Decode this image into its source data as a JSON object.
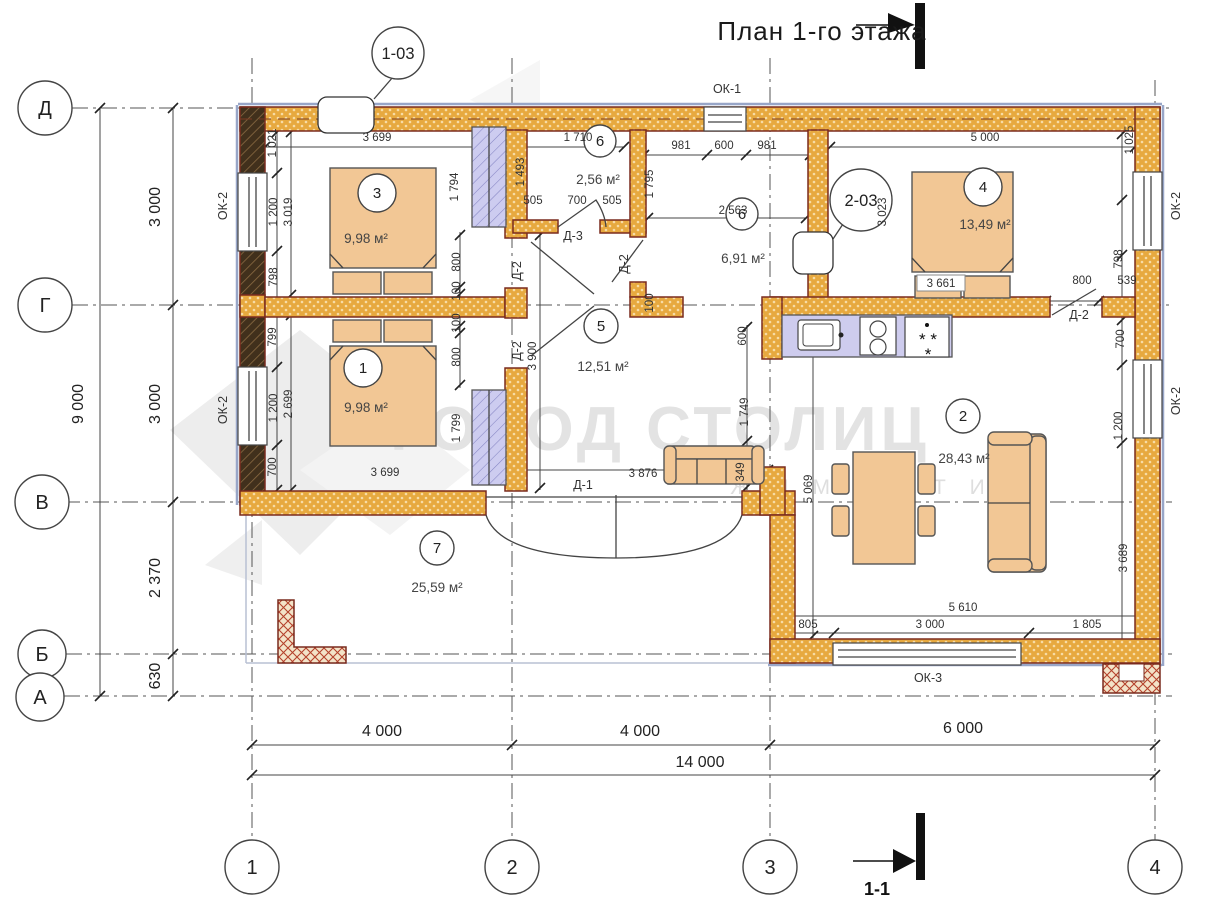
{
  "title": "План 1-го этажа",
  "watermark": {
    "main": "ГОРОД СТОЛИЦ",
    "sub": "Ж И М О С Т И"
  },
  "section": {
    "label": "1-1"
  },
  "axes": {
    "horizontal": [
      "Д",
      "Г",
      "В",
      "Б",
      "А"
    ],
    "vertical": [
      "1",
      "2",
      "3",
      "4"
    ]
  },
  "overall_dimensions": {
    "width": "14 000",
    "height": "9 000"
  },
  "rooms": [
    {
      "number": "3",
      "area": "9,98 м²"
    },
    {
      "number": "1",
      "area": "9,98 м²"
    },
    {
      "number": "4",
      "area": "13,49 м²"
    },
    {
      "number": "5",
      "area": "12,51 м²"
    },
    {
      "number": "6",
      "area": "2,56 м²"
    },
    {
      "number": "6",
      "area": "6,91 м²"
    },
    {
      "number": "2",
      "area": "28,43 м²"
    },
    {
      "number": "7",
      "area": "25,59 м²"
    }
  ],
  "windows": [
    "ОК-1",
    "ОК-2",
    "ОК-3"
  ],
  "doors": [
    "Д-1",
    "Д-2",
    "Д-3"
  ],
  "callouts": [
    "1-03",
    "2-03"
  ],
  "labels": [
    {
      "n": "dim-3699-top",
      "t": "3 699",
      "x": 377,
      "y": 141
    },
    {
      "n": "dim-1710",
      "t": "1 710",
      "x": 578,
      "y": 141
    },
    {
      "n": "dim-981-l",
      "t": "981",
      "x": 681,
      "y": 149
    },
    {
      "n": "dim-600",
      "t": "600",
      "x": 724,
      "y": 149
    },
    {
      "n": "dim-981-r",
      "t": "981",
      "x": 767,
      "y": 149
    },
    {
      "n": "dim-5000",
      "t": "5 000",
      "x": 985,
      "y": 141
    },
    {
      "n": "dim-505-l",
      "t": "505",
      "x": 533,
      "y": 204
    },
    {
      "n": "dim-700-wc",
      "t": "700",
      "x": 577,
      "y": 204
    },
    {
      "n": "dim-505-r",
      "t": "505",
      "x": 612,
      "y": 204
    },
    {
      "n": "dim-2563",
      "t": "2 563",
      "x": 733,
      "y": 214
    },
    {
      "n": "dim-3661",
      "t": "3 661",
      "x": 941,
      "y": 287,
      "c": "dimbox"
    },
    {
      "n": "dim-800-door4",
      "t": "800",
      "x": 1082,
      "y": 284
    },
    {
      "n": "dim-539",
      "t": "539",
      "x": 1127,
      "y": 284
    },
    {
      "n": "dim-3876",
      "t": "3 876",
      "x": 643,
      "y": 477
    },
    {
      "n": "dim-3699-bot",
      "t": "3 699",
      "x": 385,
      "y": 476
    },
    {
      "n": "dim-5610",
      "t": "5 610",
      "x": 963,
      "y": 611
    },
    {
      "n": "dim-805",
      "t": "805",
      "x": 808,
      "y": 628
    },
    {
      "n": "dim-3000-okno",
      "t": "3 000",
      "x": 930,
      "y": 628
    },
    {
      "n": "dim-1805",
      "t": "1 805",
      "x": 1087,
      "y": 628
    },
    {
      "n": "dim-4000-a",
      "t": "4 000",
      "x": 382,
      "y": 736,
      "c": "dimL"
    },
    {
      "n": "dim-4000-b",
      "t": "4 000",
      "x": 640,
      "y": 736,
      "c": "dimL"
    },
    {
      "n": "dim-6000",
      "t": "6 000",
      "x": 963,
      "y": 733,
      "c": "dimL"
    },
    {
      "n": "dim-14000",
      "t": "14 000",
      "x": 700,
      "y": 767,
      "c": "dimL"
    },
    {
      "n": "dim-1021",
      "t": "1 021",
      "x": 276,
      "y": 143,
      "r": -90
    },
    {
      "n": "dim-1025",
      "t": "1 025",
      "x": 1133,
      "y": 140,
      "r": -90
    },
    {
      "n": "dim-1794",
      "t": "1 794",
      "x": 458,
      "y": 187,
      "r": -90
    },
    {
      "n": "dim-1493",
      "t": "1 493",
      "x": 524,
      "y": 172,
      "r": -90
    },
    {
      "n": "dim-1795",
      "t": "1 795",
      "x": 653,
      "y": 184,
      "r": -90
    },
    {
      "n": "dim-3019",
      "t": "3 019",
      "x": 292,
      "y": 212,
      "r": -90
    },
    {
      "n": "dim-1200-l1",
      "t": "1 200",
      "x": 277,
      "y": 212,
      "r": -90
    },
    {
      "n": "dim-798-l",
      "t": "798",
      "x": 277,
      "y": 277,
      "r": -90
    },
    {
      "n": "dim-799",
      "t": "799",
      "x": 276,
      "y": 337,
      "r": -90
    },
    {
      "n": "dim-2699",
      "t": "2 699",
      "x": 292,
      "y": 404,
      "r": -90
    },
    {
      "n": "dim-1200-l2",
      "t": "1 200",
      "x": 277,
      "y": 408,
      "r": -90
    },
    {
      "n": "dim-700-l",
      "t": "700",
      "x": 276,
      "y": 467,
      "r": -90
    },
    {
      "n": "dim-3023",
      "t": "3 023",
      "x": 886,
      "y": 212,
      "r": -90
    },
    {
      "n": "dim-800-c1",
      "t": "800",
      "x": 460,
      "y": 262,
      "r": -90
    },
    {
      "n": "dim-100-c1",
      "t": "100",
      "x": 460,
      "y": 291,
      "r": -90
    },
    {
      "n": "dim-100-c2",
      "t": "100",
      "x": 460,
      "y": 323,
      "r": -90
    },
    {
      "n": "dim-800-c2",
      "t": "800",
      "x": 460,
      "y": 357,
      "r": -90
    },
    {
      "n": "dim-1799",
      "t": "1 799",
      "x": 460,
      "y": 428,
      "r": -90
    },
    {
      "n": "dim-3900",
      "t": "3 900",
      "x": 536,
      "y": 356,
      "r": -90
    },
    {
      "n": "dim-100-k",
      "t": "100",
      "x": 653,
      "y": 303,
      "r": -90
    },
    {
      "n": "dim-600-k",
      "t": "600",
      "x": 746,
      "y": 336,
      "r": -90
    },
    {
      "n": "dim-1749",
      "t": "1 749",
      "x": 748,
      "y": 412,
      "r": -90
    },
    {
      "n": "dim-349",
      "t": "349",
      "x": 744,
      "y": 472,
      "r": -90
    },
    {
      "n": "dim-5069",
      "t": "5 069",
      "x": 812,
      "y": 489,
      "r": -90
    },
    {
      "n": "dim-798-r",
      "t": "798",
      "x": 1122,
      "y": 259,
      "r": -90
    },
    {
      "n": "dim-700-r",
      "t": "700",
      "x": 1124,
      "y": 339,
      "r": -90
    },
    {
      "n": "dim-1200-r",
      "t": "1 200",
      "x": 1122,
      "y": 426,
      "r": -90
    },
    {
      "n": "dim-3689",
      "t": "3 689",
      "x": 1127,
      "y": 558,
      "r": -90
    },
    {
      "n": "dim-3000-dg",
      "t": "3 000",
      "x": 160,
      "y": 207,
      "r": -90,
      "c": "dimL"
    },
    {
      "n": "dim-3000-gv",
      "t": "3 000",
      "x": 160,
      "y": 404,
      "r": -90,
      "c": "dimL"
    },
    {
      "n": "dim-2370",
      "t": "2 370",
      "x": 160,
      "y": 578,
      "r": -90,
      "c": "dimL"
    },
    {
      "n": "dim-630",
      "t": "630",
      "x": 160,
      "y": 676,
      "r": -90,
      "c": "dimL"
    },
    {
      "n": "dim-9000",
      "t": "9 000",
      "x": 83,
      "y": 404,
      "r": -90,
      "c": "dimL"
    },
    {
      "n": "room3-area",
      "t": "9,98 м²",
      "x": 366,
      "y": 243,
      "c": "a"
    },
    {
      "n": "room1-area",
      "t": "9,98 м²",
      "x": 366,
      "y": 412,
      "c": "a"
    },
    {
      "n": "room4-area",
      "t": "13,49 м²",
      "x": 985,
      "y": 229,
      "c": "a"
    },
    {
      "n": "room5-area",
      "t": "12,51 м²",
      "x": 603,
      "y": 371,
      "c": "a"
    },
    {
      "n": "room6-area",
      "t": "2,56 м²",
      "x": 598,
      "y": 184,
      "c": "a"
    },
    {
      "n": "kitchen-area",
      "t": "6,91 м²",
      "x": 743,
      "y": 263,
      "c": "a"
    },
    {
      "n": "room2-area",
      "t": "28,43 м²",
      "x": 964,
      "y": 463,
      "c": "a"
    },
    {
      "n": "room7-area",
      "t": "25,59 м²",
      "x": 437,
      "y": 592,
      "c": "a"
    },
    {
      "n": "window-label-ok1",
      "t": "ОК-1",
      "x": 727,
      "y": 93,
      "c": "w"
    },
    {
      "n": "window-label-ok2-l1",
      "t": "ОК-2",
      "x": 227,
      "y": 206,
      "r": -90,
      "c": "w"
    },
    {
      "n": "window-label-ok2-l2",
      "t": "ОК-2",
      "x": 227,
      "y": 410,
      "r": -90,
      "c": "w"
    },
    {
      "n": "window-label-ok2-r1",
      "t": "ОК-2",
      "x": 1180,
      "y": 206,
      "r": -90,
      "c": "w"
    },
    {
      "n": "window-label-ok2-r2",
      "t": "ОК-2",
      "x": 1180,
      "y": 401,
      "r": -90,
      "c": "w"
    },
    {
      "n": "window-label-ok3",
      "t": "ОК-3",
      "x": 928,
      "y": 682,
      "c": "w"
    },
    {
      "n": "door-label-d1",
      "t": "Д-1",
      "x": 583,
      "y": 489,
      "c": "w"
    },
    {
      "n": "door-label-d3",
      "t": "Д-3",
      "x": 573,
      "y": 240,
      "c": "w"
    },
    {
      "n": "door-label-d2-a",
      "t": "Д-2",
      "x": 521,
      "y": 271,
      "r": -90,
      "c": "w"
    },
    {
      "n": "door-label-d2-b",
      "t": "Д-2",
      "x": 521,
      "y": 351,
      "r": -90,
      "c": "w"
    },
    {
      "n": "door-label-d2-c",
      "t": "Д-2",
      "x": 628,
      "y": 264,
      "r": -90,
      "c": "w"
    },
    {
      "n": "door-label-d2-d",
      "t": "Д-2",
      "x": 1079,
      "y": 319,
      "c": "w"
    },
    {
      "n": "section-label",
      "t": "1-1",
      "x": 877,
      "y": 895,
      "c": "sec"
    },
    {
      "n": "fridge-stars",
      "t": "*  *",
      "x": 928,
      "y": 345,
      "c": "star"
    },
    {
      "n": "fridge-star",
      "t": "*",
      "x": 928,
      "y": 360,
      "c": "star"
    }
  ],
  "circles": [
    {
      "n": "axis-D",
      "t": "Д",
      "x": 45,
      "y": 108,
      "rad": 27,
      "c": "ax"
    },
    {
      "n": "axis-G",
      "t": "Г",
      "x": 45,
      "y": 305,
      "rad": 27,
      "c": "ax"
    },
    {
      "n": "axis-V",
      "t": "В",
      "x": 42,
      "y": 502,
      "rad": 27,
      "c": "ax"
    },
    {
      "n": "axis-B",
      "t": "Б",
      "x": 42,
      "y": 654,
      "rad": 24,
      "c": "ax"
    },
    {
      "n": "axis-A",
      "t": "А",
      "x": 40,
      "y": 697,
      "rad": 24,
      "c": "ax"
    },
    {
      "n": "axis-1",
      "t": "1",
      "x": 252,
      "y": 867,
      "rad": 27,
      "c": "ax"
    },
    {
      "n": "axis-2",
      "t": "2",
      "x": 512,
      "y": 867,
      "rad": 27,
      "c": "ax"
    },
    {
      "n": "axis-3",
      "t": "3",
      "x": 770,
      "y": 867,
      "rad": 27,
      "c": "ax"
    },
    {
      "n": "axis-4",
      "t": "4",
      "x": 1155,
      "y": 867,
      "rad": 27,
      "c": "ax"
    },
    {
      "n": "room-circle-3",
      "t": "3",
      "x": 377,
      "y": 193,
      "rad": 19,
      "c": "rm"
    },
    {
      "n": "room-circle-1",
      "t": "1",
      "x": 363,
      "y": 368,
      "rad": 19,
      "c": "rm"
    },
    {
      "n": "room-circle-4",
      "t": "4",
      "x": 983,
      "y": 187,
      "rad": 19,
      "c": "rm"
    },
    {
      "n": "room-circle-5",
      "t": "5",
      "x": 601,
      "y": 326,
      "rad": 17,
      "c": "rm"
    },
    {
      "n": "room-circle-6",
      "t": "6",
      "x": 600,
      "y": 141,
      "rad": 16,
      "c": "rm"
    },
    {
      "n": "room-circle-6b",
      "t": "6",
      "x": 742,
      "y": 214,
      "rad": 16,
      "c": "rm"
    },
    {
      "n": "room-circle-2",
      "t": "2",
      "x": 963,
      "y": 416,
      "rad": 17,
      "c": "rm"
    },
    {
      "n": "room-circle-7",
      "t": "7",
      "x": 437,
      "y": 548,
      "rad": 17,
      "c": "rm"
    },
    {
      "n": "callout-1-03",
      "t": "1-03",
      "x": 398,
      "y": 53,
      "rad": 26,
      "c": "co"
    },
    {
      "n": "callout-2-03",
      "t": "2-03",
      "x": 861,
      "y": 200,
      "rad": 31,
      "c": "co"
    }
  ]
}
